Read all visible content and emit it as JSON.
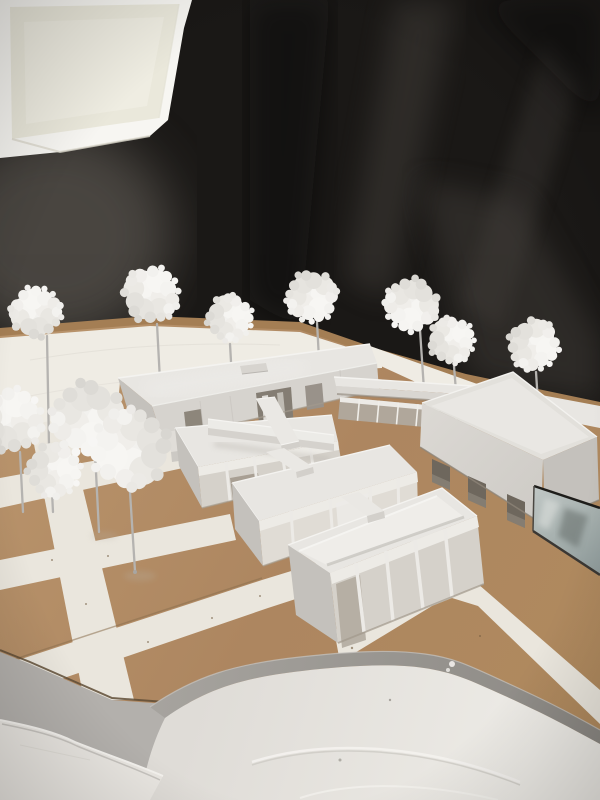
{
  "scene": {
    "title": "Photograph of a white architectural scale model on a cardboard base, lit by a studio softbox against a black fabric backdrop",
    "setting": "studio photograph, no visible text",
    "objects": {
      "softbox": "studio softbox light (top-left corner)",
      "backdrop": "black fabric backdrop with sheen streaks",
      "base": "kraft cardboard site base",
      "plaza": "white paper plaza at rear",
      "streets": "white street grid over cardboard blocks",
      "slab_building": "long low slab building with recessed entries",
      "walkway_canopy": "covered walkway canopy linking buildings",
      "glazed_corridor": "low glazed corridor",
      "right_building": "taller building with three punched window openings",
      "pavilion_1": "glazed pavilion (rear of row of three)",
      "pavilion_2": "glazed pavilion (middle of row)",
      "pavilion_3": "open-roof glazed pavilion (front of row)",
      "bridges": "white connecting bridges between pavilions",
      "pool": "reflective glass pool beside right building",
      "terrain": "white contour terrain plateau with grey edge band",
      "foam_piece": "white foam contour piece at lower-left",
      "table": "grey table surface beyond base edge",
      "trees": "white cotton foam trees on grey wire stems"
    },
    "counts": {
      "back_row_trees": 7,
      "left_cluster_trees": 4,
      "pavilions": 3,
      "bridges": 4
    },
    "palette": {
      "backdrop": "#1a1816",
      "softbox_rim": "#f7f6f2",
      "softbox_panel": "#eae8db",
      "cardboard": "#b28c62",
      "strip": "#a47e54",
      "plaza": "#efece4",
      "street": "#eae6dd",
      "roof": "#e8e6e2",
      "roof_dark": "#dedcd7",
      "facade": "#d6d3ce",
      "end_face": "#c4c1bc",
      "rim": "#f4f3f0",
      "opening": "#847d73",
      "pane": "#d5d1ca",
      "pane_dark": "#a89f93",
      "mullion": "#edebe6",
      "corridor": "#b0a99e",
      "window": "#6e675d",
      "pool_hi": "#c0c7c5",
      "pool_lo": "#8e9a9a",
      "pool_edge": "#22211e",
      "band": "#9c9994",
      "terrain": "#e7e4df",
      "contour": "#f4f2ee",
      "table": "#b3b0ac",
      "foam": "#e9e6e1",
      "stem": "#b5b3b0",
      "seam": "#a0978a"
    },
    "trees": {
      "back_row": [
        {
          "x": 36,
          "y": 314,
          "s": 1.05,
          "r": 0,
          "stem": [
            47,
            336,
            49,
            447
          ],
          "foot": true
        },
        {
          "x": 150,
          "y": 296,
          "s": 1.15,
          "r": 40,
          "stem": [
            157,
            324,
            160,
            381
          ],
          "foot": false
        },
        {
          "x": 228,
          "y": 318,
          "s": 0.95,
          "r": 90,
          "stem": [
            230,
            344,
            232,
            379
          ],
          "foot": false
        },
        {
          "x": 311,
          "y": 295,
          "s": 1.05,
          "r": 160,
          "stem": [
            317,
            322,
            320,
            378
          ],
          "foot": false
        },
        {
          "x": 412,
          "y": 303,
          "s": 1.1,
          "r": 200,
          "stem": [
            420,
            330,
            424,
            390
          ],
          "foot": false
        },
        {
          "x": 450,
          "y": 341,
          "s": 0.95,
          "r": 70,
          "stem": [
            454,
            366,
            457,
            404
          ],
          "foot": false
        },
        {
          "x": 532,
          "y": 344,
          "s": 1.05,
          "r": 120,
          "stem": [
            536,
            372,
            539,
            418
          ],
          "foot": false
        }
      ],
      "left_cluster": [
        {
          "x": 10,
          "y": 422,
          "s": 1.3,
          "r": 30,
          "stem": [
            20,
            452,
            23,
            512
          ],
          "foot": false
        },
        {
          "x": 52,
          "y": 470,
          "s": 1.1,
          "r": 100,
          "stem": [
            52,
            492,
            53,
            512
          ],
          "foot": false
        },
        {
          "x": 88,
          "y": 416,
          "s": 1.5,
          "r": 180,
          "stem": [
            95,
            452,
            99,
            532
          ],
          "foot": false
        },
        {
          "x": 133,
          "y": 448,
          "s": 1.6,
          "r": 260,
          "stem": [
            130,
            492,
            135,
            571
          ],
          "foot": true
        }
      ]
    }
  }
}
